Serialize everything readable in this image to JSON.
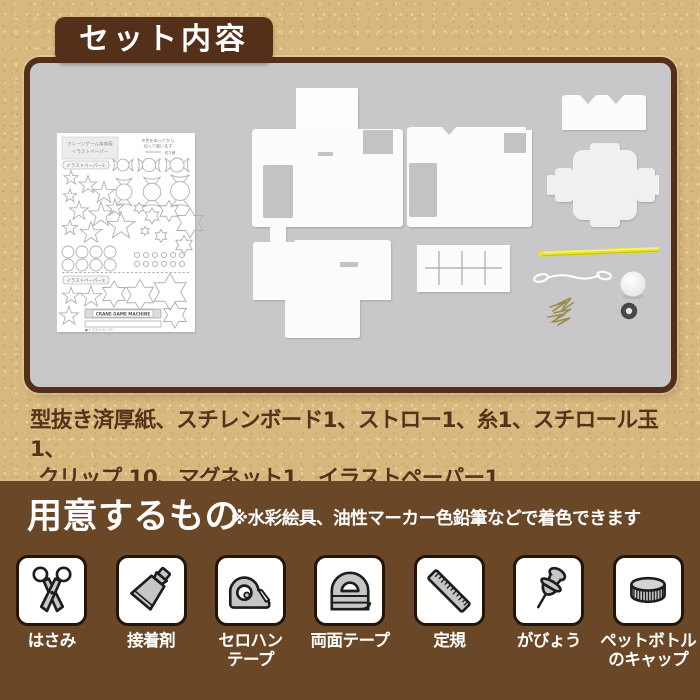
{
  "palette": {
    "kraft_bg": "#d8b87e",
    "brown_dark": "#54301a",
    "brown_section": "#6a4827",
    "panel_gray": "#c8c8ca",
    "text_brown": "#54331d",
    "straw_yellow": "#e9e42e"
  },
  "header": {
    "title": "セット内容"
  },
  "set_panel": {
    "illust_paper": {
      "corner_box_line1": "クレーンゲーム本体用",
      "corner_box_line2": "イラストペーパー",
      "cut_note_line1": "※色をぬってから",
      "cut_note_line2": "切って使います",
      "cut_note_line3": "切り線",
      "sheet1_label": "イラストペーパー①",
      "sheet2_label": "イラストペーパー②",
      "machine_plate": "CRANE GAME MACHINE",
      "footnote": "●イラストペーパー"
    }
  },
  "contents_text": {
    "line1": "型抜き済厚紙、スチレンボード1、ストロー1、糸1、スチロール玉1、",
    "line2": "クリップ 10、マグネット1、イラストペーパー1"
  },
  "prepare_section": {
    "title": "用意するもの",
    "note": "※水彩絵具、油性マーカー色鉛筆などで着色できます",
    "tools": [
      {
        "label": "はさみ",
        "icon": "scissors-icon"
      },
      {
        "label": "接着剤",
        "icon": "glue-tube-icon"
      },
      {
        "label": "セロハン\nテープ",
        "icon": "cellophane-tape-icon"
      },
      {
        "label": "両面テープ",
        "icon": "double-sided-tape-icon"
      },
      {
        "label": "定規",
        "icon": "ruler-icon"
      },
      {
        "label": "がびょう",
        "icon": "pushpin-icon"
      },
      {
        "label": "ペットボトル\nのキャップ",
        "icon": "bottle-cap-icon"
      }
    ]
  }
}
